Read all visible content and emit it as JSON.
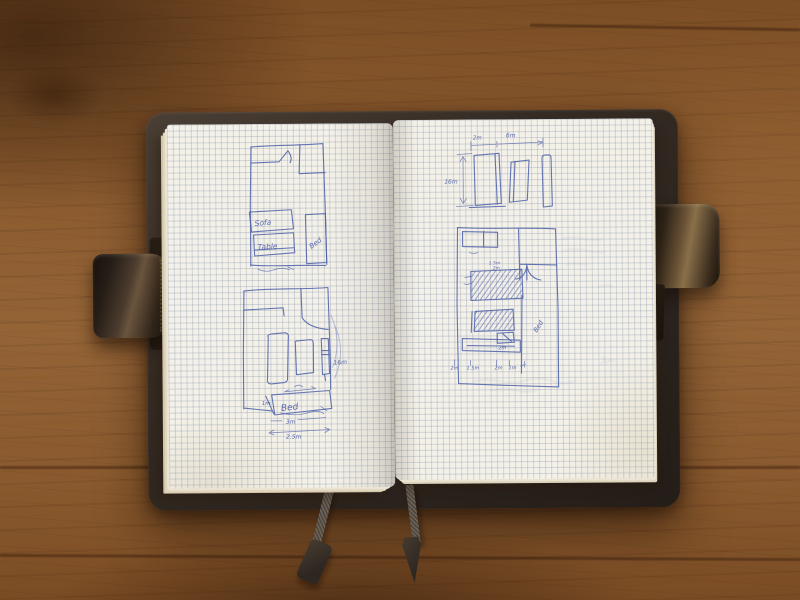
{
  "notebook": {
    "left_page": {
      "top_plan": {
        "sofa_label": "Sofa",
        "table_label": "Table",
        "bed_label": "Bed"
      },
      "bottom_plan": {
        "bed_label": "Bed",
        "dim_small": "1m",
        "dim_side": "16m",
        "dim_width": "3m",
        "dim_total": "2.5m"
      }
    },
    "right_page": {
      "elevation": {
        "dim_top_left": "2m",
        "dim_top": "6m",
        "dim_height": "16m"
      },
      "floor_plan": {
        "bed_label": "Bed",
        "dim_upper_1": "1.5m",
        "dim_upper_2": "2m",
        "dim_inner": "2m",
        "bottom_dims": [
          "2m",
          "1.5m",
          "2m",
          "1m"
        ]
      }
    }
  },
  "colors": {
    "ink": "#4d5ea9",
    "paper": "#f4f1e8",
    "grid": "#c5cbd9",
    "leather": "#352c25",
    "wood": "#8a5a2e"
  }
}
